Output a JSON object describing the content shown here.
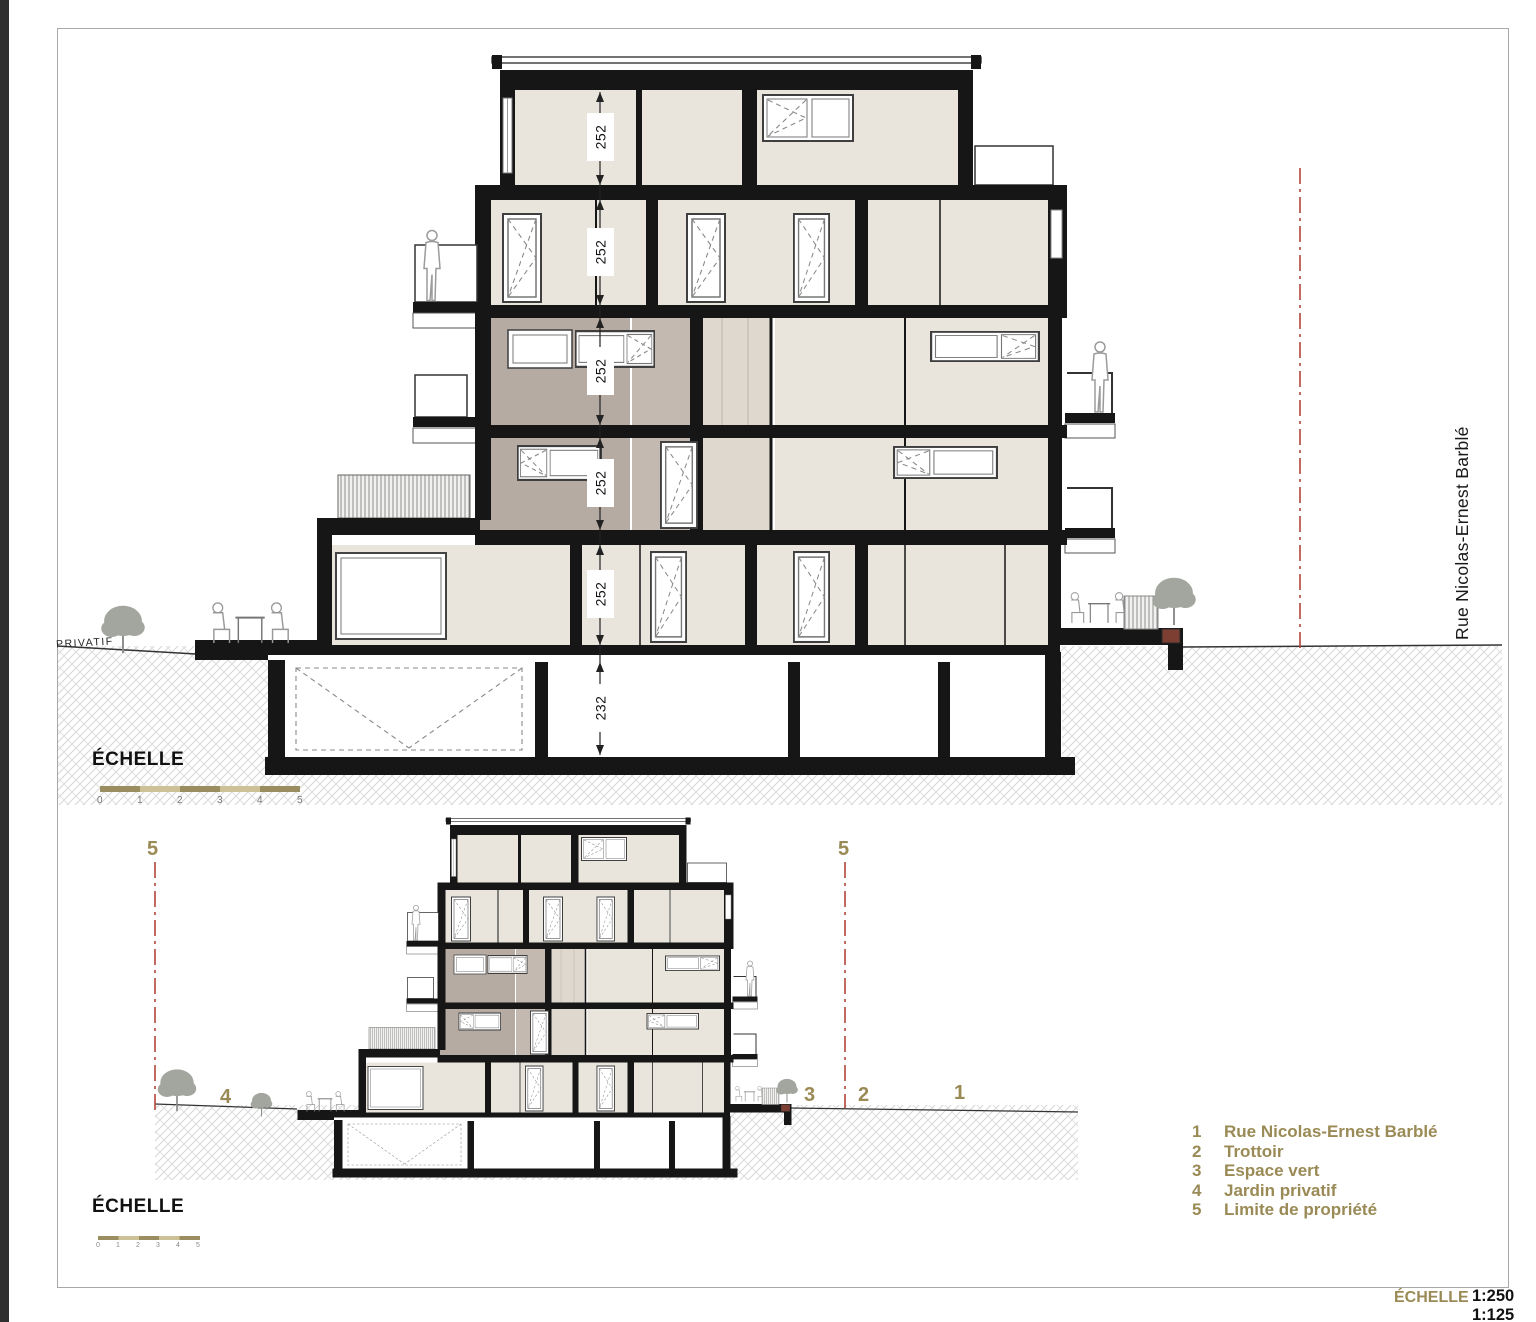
{
  "drawing": {
    "dim_labels": [
      "252",
      "252",
      "252",
      "252",
      "252",
      "232"
    ],
    "street_name": "Rue Nicolas-Ernest Barblé",
    "privatif": "PRIVATIF",
    "scale_heading": "ÉCHELLE",
    "scale_ticks": [
      "0",
      "1",
      "2",
      "3",
      "4",
      "5"
    ]
  },
  "bottom": {
    "scale_heading": "ÉCHELLE",
    "scale_ticks": [
      "0",
      "1",
      "2",
      "3",
      "4",
      "5"
    ],
    "markers": {
      "left_limit": "5",
      "right_limit": "5",
      "garden": "4",
      "green": "3",
      "sidewalk": "2",
      "street": "1"
    }
  },
  "legend": {
    "items": [
      {
        "num": "1",
        "label": "Rue Nicolas-Ernest Barblé"
      },
      {
        "num": "2",
        "label": "Trottoir"
      },
      {
        "num": "3",
        "label": "Espace vert"
      },
      {
        "num": "4",
        "label": "Jardin privatif"
      },
      {
        "num": "5",
        "label": "Limite de propriété"
      }
    ]
  },
  "footer": {
    "scale_heading": "ÉCHELLE",
    "scales": [
      "1:250",
      "1:125"
    ]
  },
  "colors": {
    "accent_olive": "#9a8a55",
    "limit_red": "#b0453b",
    "wall_black": "#161616",
    "room_beige": "#e9e5dc",
    "room_mauve": "#b6aba3",
    "planter_red": "#7c3f32"
  }
}
